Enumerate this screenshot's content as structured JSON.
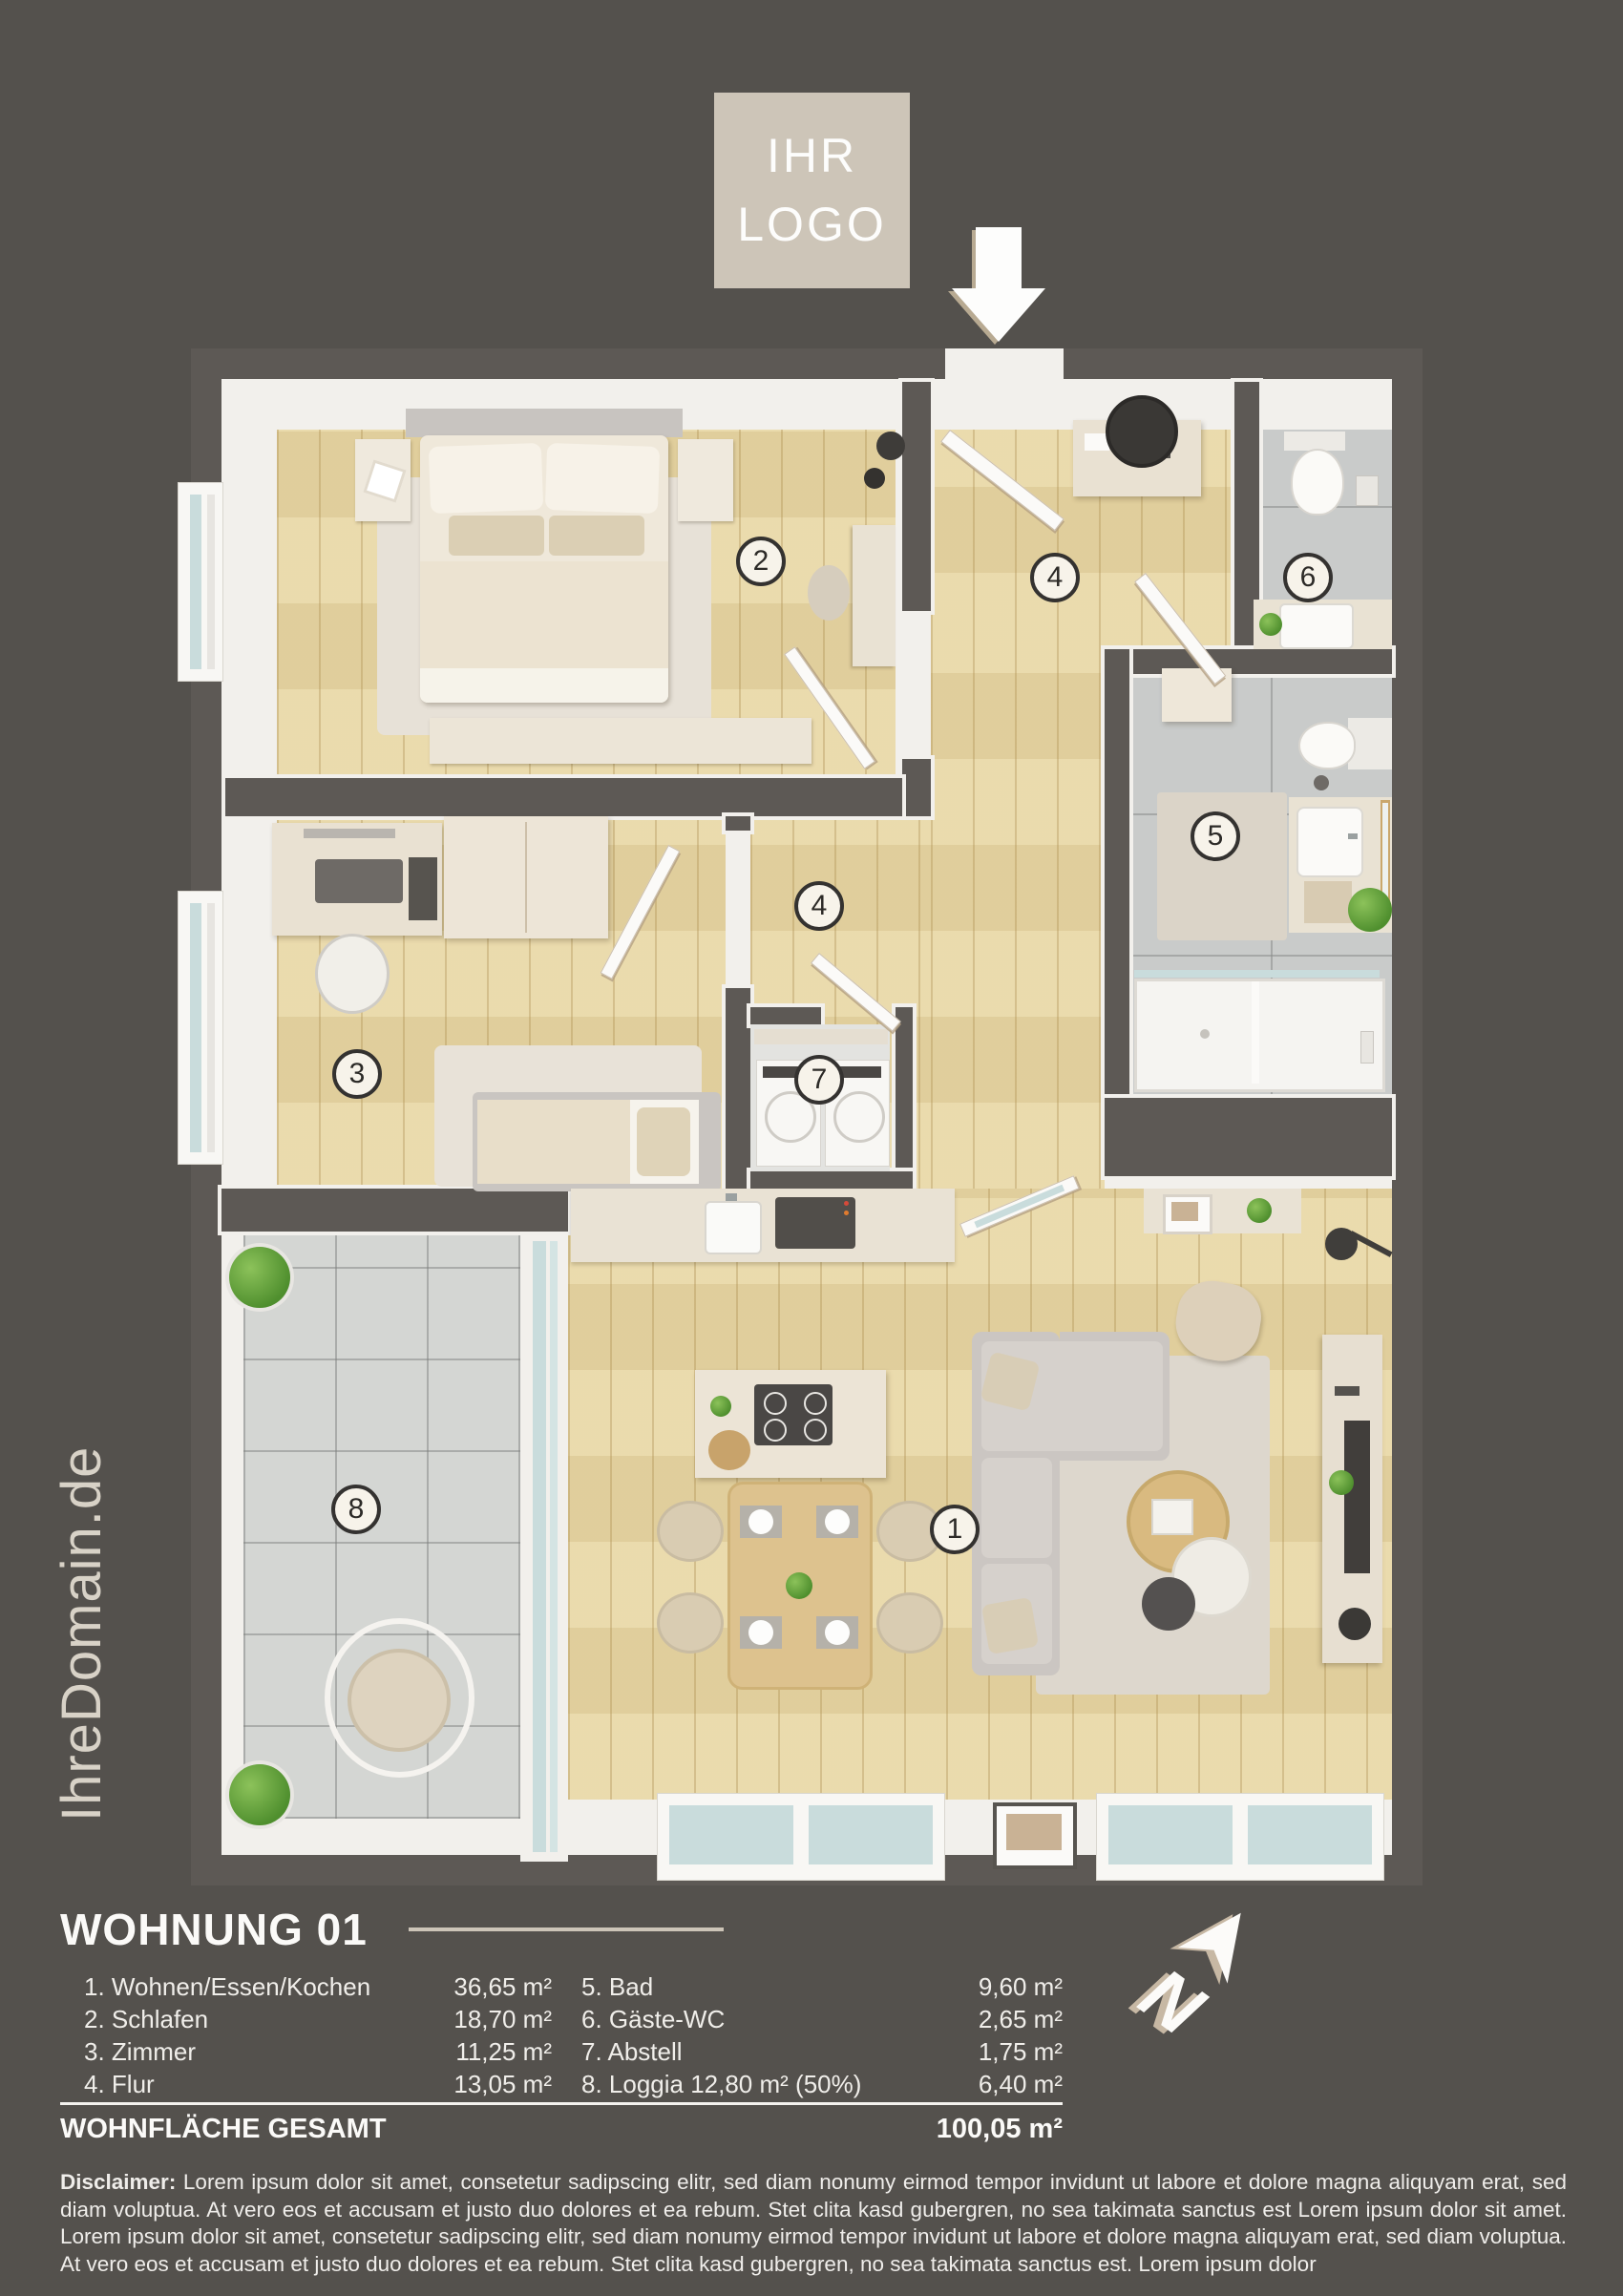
{
  "branding": {
    "logo_line1": "IHR",
    "logo_line2": "LOGO",
    "domain": "IhreDomain.de"
  },
  "plan": {
    "badges": [
      "2",
      "4",
      "6",
      "5",
      "4",
      "3",
      "7",
      "8",
      "1"
    ]
  },
  "legend": {
    "title": "WOHNUNG 01",
    "rows_left": [
      {
        "label": "1. Wohnen/Essen/Kochen",
        "area": "36,65 m²"
      },
      {
        "label": "2. Schlafen",
        "area": "18,70 m²"
      },
      {
        "label": "3. Zimmer",
        "area": "11,25 m²"
      },
      {
        "label": "4. Flur",
        "area": "13,05 m²"
      }
    ],
    "rows_right": [
      {
        "label": "5. Bad",
        "area": "9,60 m²"
      },
      {
        "label": "6. Gäste-WC",
        "area": "2,65 m²"
      },
      {
        "label": "7. Abstell",
        "area": "1,75 m²"
      },
      {
        "label": "8. Loggia 12,80 m² (50%)",
        "area": "6,40 m²"
      }
    ],
    "total_label": "WOHNFLÄCHE GESAMT",
    "total_area": "100,05 m²"
  },
  "disclaimer": {
    "label": "Disclaimer:",
    "text": " Lorem ipsum dolor sit amet, consetetur sadipscing elitr, sed diam nonumy eirmod tempor invidunt ut labore et dolore magna aliquyam erat, sed diam voluptua. At vero eos et accusam et justo duo dolores et ea rebum. Stet clita kasd gubergren, no sea takimata sanctus est Lorem ipsum dolor sit amet. Lorem ipsum dolor sit amet, consetetur sadipscing elitr, sed diam nonumy eirmod tempor invidunt ut labore et dolore magna aliquyam erat, sed diam voluptua. At vero eos et accusam et justo duo dolores et ea rebum. Stet clita kasd gubergren, no sea takimata sanctus est. Lorem ipsum dolor"
  },
  "compass": {
    "label": "N"
  },
  "palette": {
    "background": "#54514d",
    "wall": "#5d5955",
    "wall_face": "#f2f0ec",
    "wood": "#e9d8a7",
    "tile_bath": "#c9cbca",
    "tile_loggia": "#d4d6d3",
    "accent_beige": "#cdc5b8",
    "text": "#f2f0ec"
  }
}
